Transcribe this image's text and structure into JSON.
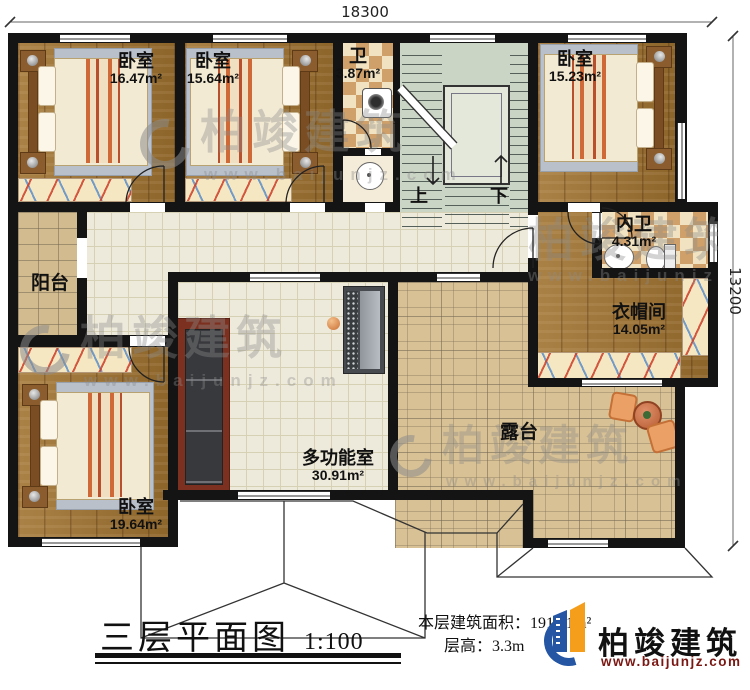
{
  "dimensions": {
    "top": "18300",
    "right": "13200"
  },
  "rooms": {
    "bedroom_tl": {
      "label": "卧室",
      "area": "16.47m²"
    },
    "bedroom_tm": {
      "label": "卧室",
      "area": "15.64m²"
    },
    "bath": {
      "label": "卫",
      "area": "3.87m²"
    },
    "bedroom_tr": {
      "label": "卧室",
      "area": "15.23m²"
    },
    "inner_bath": {
      "label": "内卫",
      "area": "4.31m²"
    },
    "cloakroom": {
      "label": "衣帽间",
      "area": "14.05m²"
    },
    "balcony": {
      "label": "阳台"
    },
    "bedroom_bl": {
      "label": "卧室",
      "area": "19.64m²"
    },
    "multi_room": {
      "label": "多功能室",
      "area": "30.91m²"
    },
    "terrace": {
      "label": "露台"
    }
  },
  "stairs": {
    "up": "上",
    "down": "下"
  },
  "footer": {
    "title": "三层平面图",
    "scale": "1:100",
    "area_label": "本层建筑面积：",
    "area_value": "191.41m²",
    "height_label": "层高：",
    "height_value": "3.3m"
  },
  "brand": {
    "name": "柏竣建筑",
    "url": "www.baijunjz.com"
  },
  "watermark": {
    "name": "柏竣建筑",
    "url": "www.baijunjz.com"
  },
  "colors": {
    "wall": "#141414",
    "wood": "#a07331",
    "tile": "#eeeadb",
    "checker_dark": "#cfa06a",
    "checker_light": "#f1e3c2",
    "stone": "#d8c194",
    "stairs_floor": "#cbd5c5",
    "brand_blue": "#2456a4",
    "brand_orange": "#f59e1c",
    "brand_url_red": "#7a1712"
  }
}
